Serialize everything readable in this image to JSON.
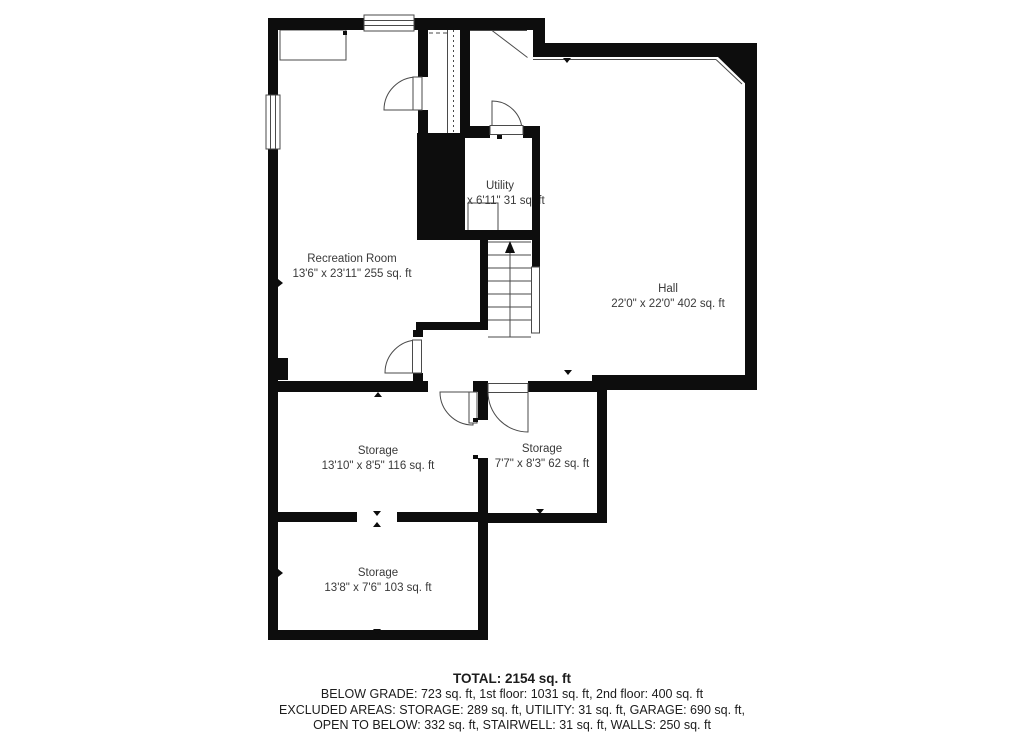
{
  "floorplan": {
    "colors": {
      "wall": "#0d0d0d",
      "line": "#4a4a4a",
      "background": "#ffffff",
      "label_text": "#3a3a3a"
    },
    "rooms": [
      {
        "id": "recreation-room",
        "name": "Recreation Room",
        "dims": "13'6\" x 23'11\" 255 sq. ft"
      },
      {
        "id": "utility",
        "name": "Utility",
        "dims": "x 6'11\" 31 sq. ft"
      },
      {
        "id": "hall",
        "name": "Hall",
        "dims": "22'0\" x 22'0\" 402 sq. ft"
      },
      {
        "id": "storage-1",
        "name": "Storage",
        "dims": "13'10\" x 8'5\" 116 sq. ft"
      },
      {
        "id": "storage-2",
        "name": "Storage",
        "dims": "7'7\" x 8'3\" 62 sq. ft"
      },
      {
        "id": "storage-3",
        "name": "Storage",
        "dims": "13'8\" x 7'6\" 103 sq. ft"
      }
    ],
    "features": [
      "stairs-up-arrow",
      "utility-equipment",
      "built-in-closet",
      "railing",
      "windows",
      "doors"
    ]
  },
  "summary": {
    "total": "TOTAL: 2154 sq. ft",
    "line1": "BELOW GRADE: 723 sq. ft, 1st floor: 1031 sq. ft, 2nd floor: 400 sq. ft",
    "line2": "EXCLUDED AREAS: STORAGE: 289 sq. ft, UTILITY: 31 sq. ft, GARAGE: 690 sq. ft,",
    "line3": "OPEN TO BELOW: 332 sq. ft, STAIRWELL: 31 sq. ft, WALLS: 250 sq. ft"
  }
}
